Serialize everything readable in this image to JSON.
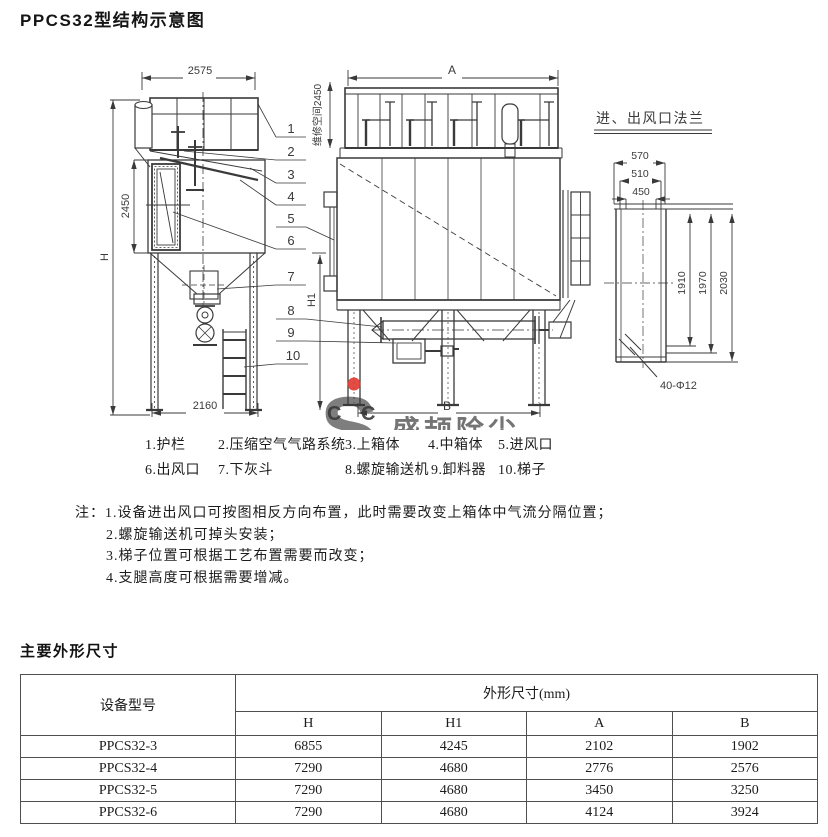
{
  "page": {
    "title": "PPCS32型结构示意图"
  },
  "drawing": {
    "left_view": {
      "dim_width": "2575",
      "dim_height": "H",
      "dim_body": "2450",
      "dim_base": "2160",
      "dim_h1": "H1"
    },
    "front_view": {
      "dim_a": "A",
      "dim_b": "B",
      "dim_clearance": "维修空间2450"
    },
    "flange_view": {
      "title": "进、出风口法兰",
      "dim_outer": "570",
      "dim_mid": "510",
      "dim_inner": "450",
      "dim_v1": "1910",
      "dim_v2": "1970",
      "dim_v3": "2030",
      "holes": "40-Φ12"
    },
    "leaders": [
      "1",
      "2",
      "3",
      "4",
      "5",
      "6",
      "7",
      "8",
      "9",
      "10"
    ]
  },
  "watermark": {
    "letter_s": "S",
    "letters_c": "C C",
    "company": "盛颉除尘"
  },
  "legend": {
    "row1": [
      "1.护栏",
      "2.压缩空气气路系统",
      "3.上箱体",
      "4.中箱体",
      "5.进风口"
    ],
    "row2": [
      "6.出风口",
      "7.下灰斗",
      "8.螺旋输送机",
      "9.卸料器",
      "10.梯子"
    ]
  },
  "notes": {
    "prefix": "注：",
    "items": [
      "1.设备进出风口可按图相反方向布置，此时需要改变上箱体中气流分隔位置；",
      "2.螺旋输送机可掉头安装；",
      "3.梯子位置可根据工艺布置需要而改变；",
      "4.支腿高度可根据需要增减。"
    ]
  },
  "dimensions_section": {
    "title": "主要外形尺寸",
    "table": {
      "model_header": "设备型号",
      "span_header": "外形尺寸(mm)",
      "sub_headers": [
        "H",
        "H1",
        "A",
        "B"
      ],
      "rows": [
        {
          "model": "PPCS32-3",
          "h": "6855",
          "h1": "4245",
          "a": "2102",
          "b": "1902"
        },
        {
          "model": "PPCS32-4",
          "h": "7290",
          "h1": "4680",
          "a": "2776",
          "b": "2576"
        },
        {
          "model": "PPCS32-5",
          "h": "7290",
          "h1": "4680",
          "a": "3450",
          "b": "3250"
        },
        {
          "model": "PPCS32-6",
          "h": "7290",
          "h1": "4680",
          "a": "4124",
          "b": "3924"
        }
      ]
    }
  },
  "colors": {
    "line": "#3a3a3a",
    "text": "#1b1b1b",
    "wm_green": "#8ade4e",
    "wm_blue": "#5b8fd9",
    "wm_yellow": "#f2d400",
    "wm_red": "#e0392f"
  }
}
